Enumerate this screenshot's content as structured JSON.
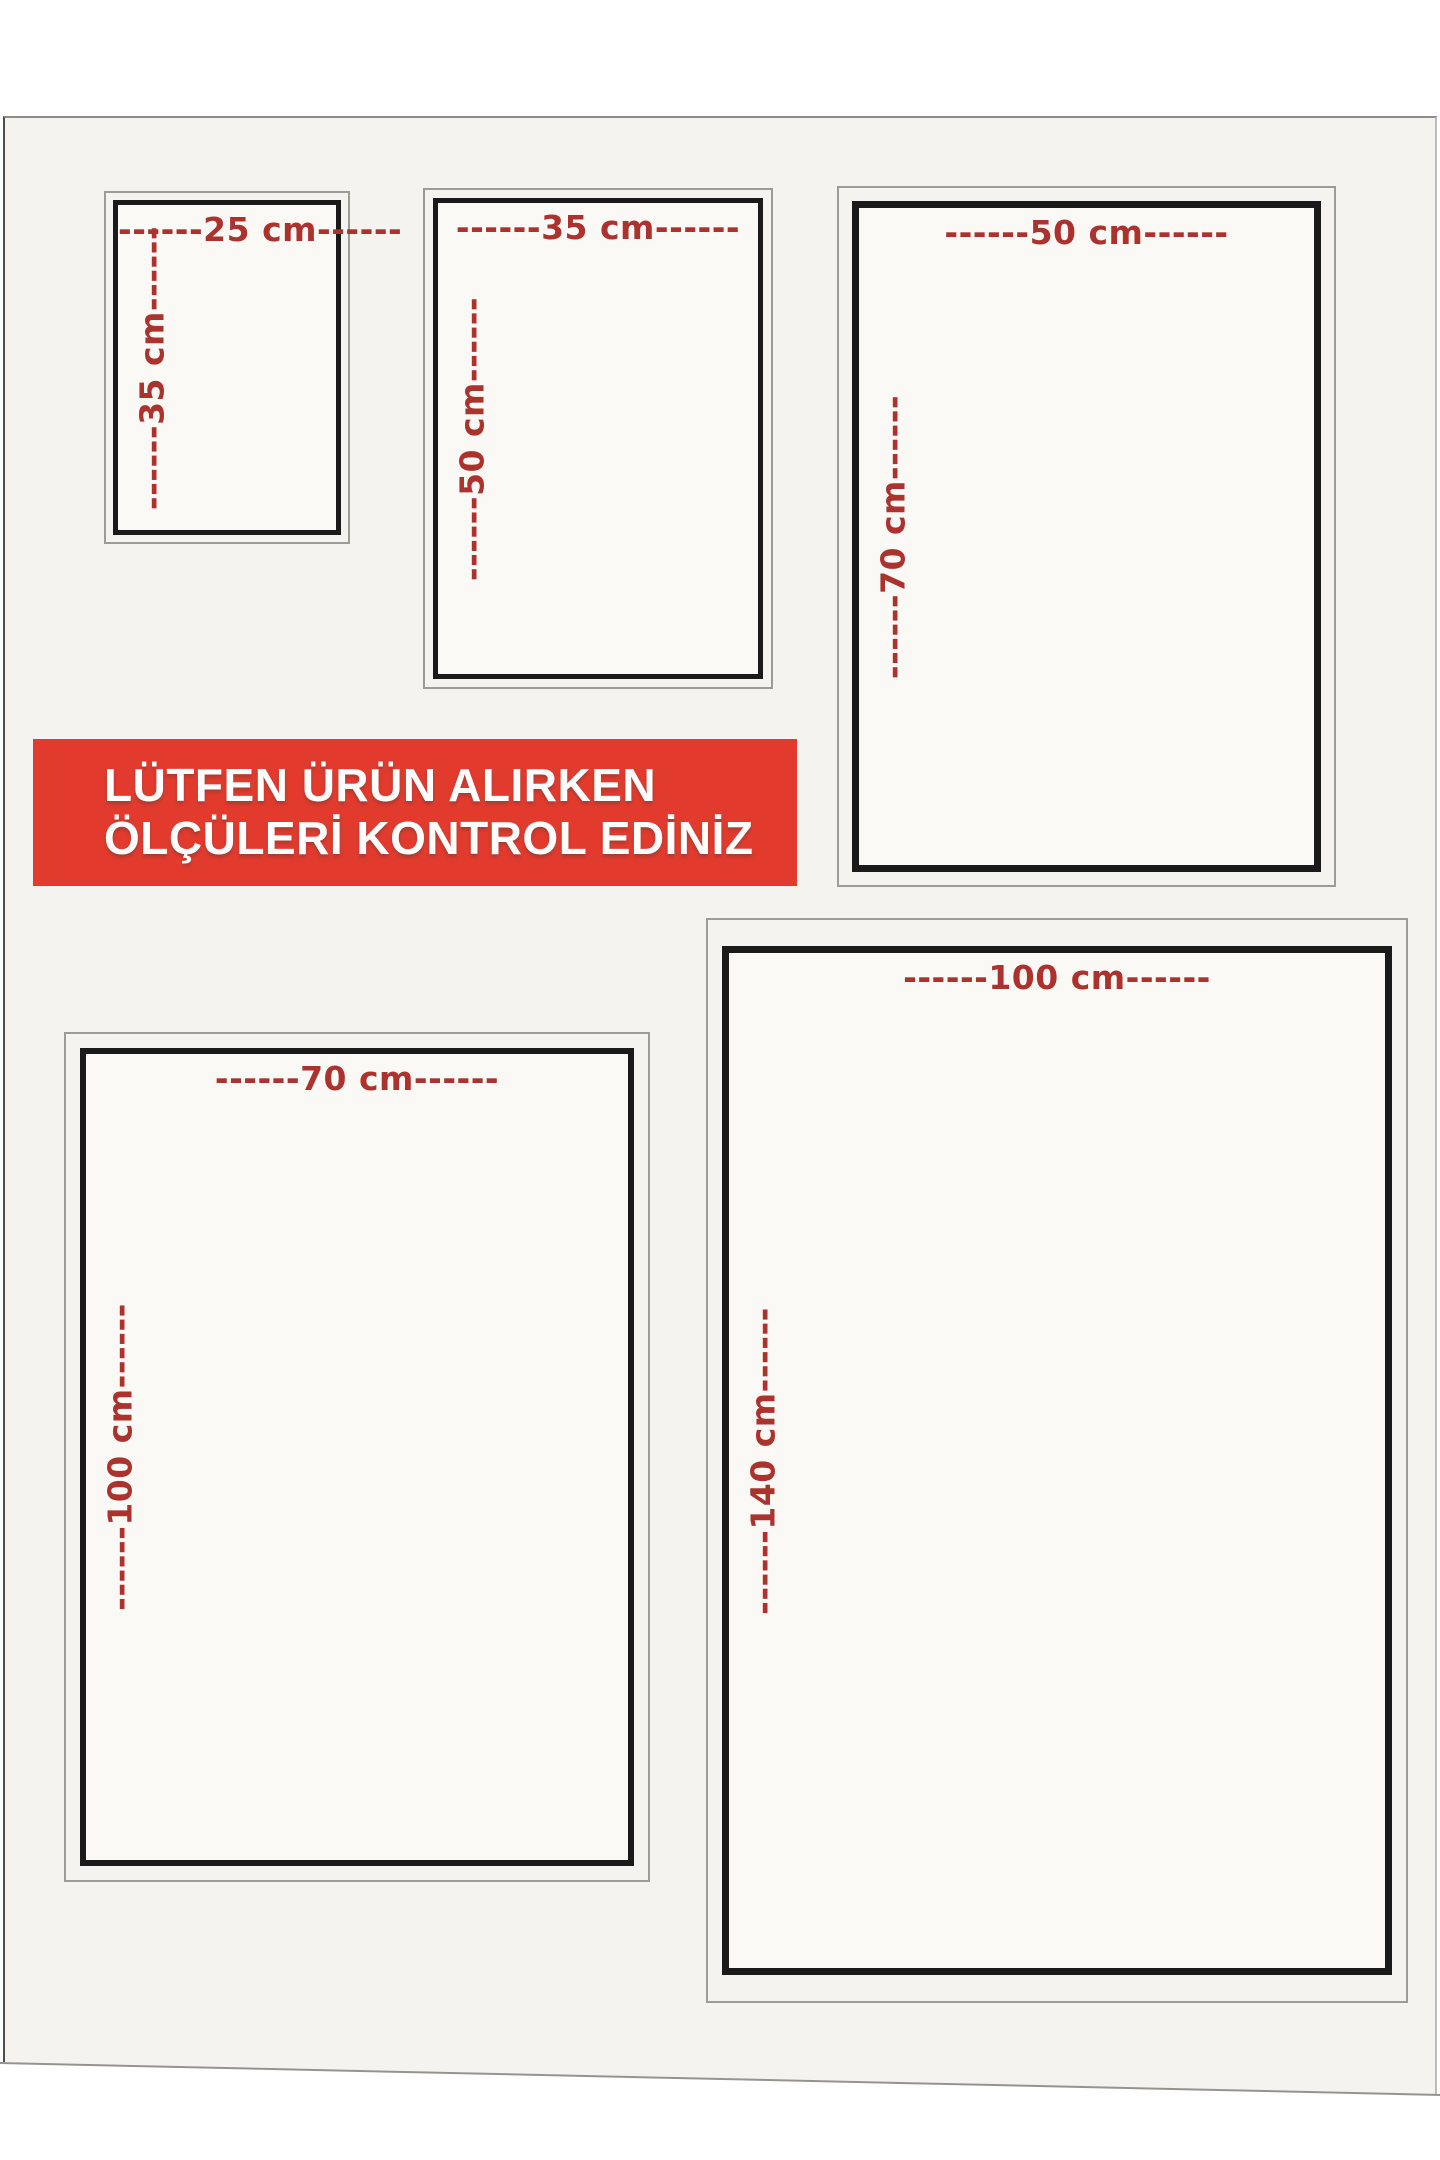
{
  "poster": {
    "banner": {
      "line1": "LÜTFEN ÜRÜN ALIRKEN",
      "line2": "ÖLÇÜLERİ KONTROL EDİNİZ"
    },
    "size_boxes": [
      {
        "width_cm": 25,
        "height_cm": 35,
        "top_label": "------25 cm------",
        "side_label": "------35 cm------"
      },
      {
        "width_cm": 35,
        "height_cm": 50,
        "top_label": "------35 cm------",
        "side_label": "------50 cm------"
      },
      {
        "width_cm": 50,
        "height_cm": 70,
        "top_label": "------50 cm------",
        "side_label": "------70 cm------"
      },
      {
        "width_cm": 70,
        "height_cm": 100,
        "top_label": "------70 cm------",
        "side_label": "------100 cm------"
      },
      {
        "width_cm": 100,
        "height_cm": 140,
        "top_label": "------100 cm------",
        "side_label": "------140 cm------"
      }
    ],
    "colors": {
      "banner_bg": "#e23b2e",
      "banner_text": "#ffffff",
      "dimension_text": "#ac332d",
      "frame_black": "#1a1a1a",
      "frame_gray": "#9b9b98",
      "photo_bg": "#f5f3f0",
      "paper_white": "#fbf9f6"
    }
  }
}
